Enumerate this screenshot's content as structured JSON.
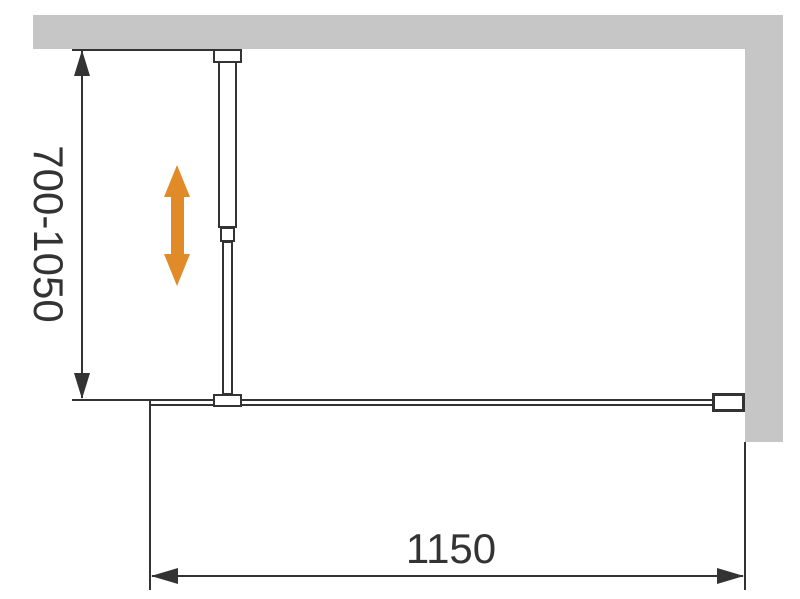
{
  "labels": {
    "height_range": "700-1050",
    "width": "1150"
  },
  "colors": {
    "wall": "#c6c6c6",
    "line": "#333333",
    "adjust_arrow": "#e08a28"
  },
  "icons": {
    "adjust_arrow": "vertical-double-arrow",
    "dimension_arrows": "solid-triangle-arrowheads"
  }
}
